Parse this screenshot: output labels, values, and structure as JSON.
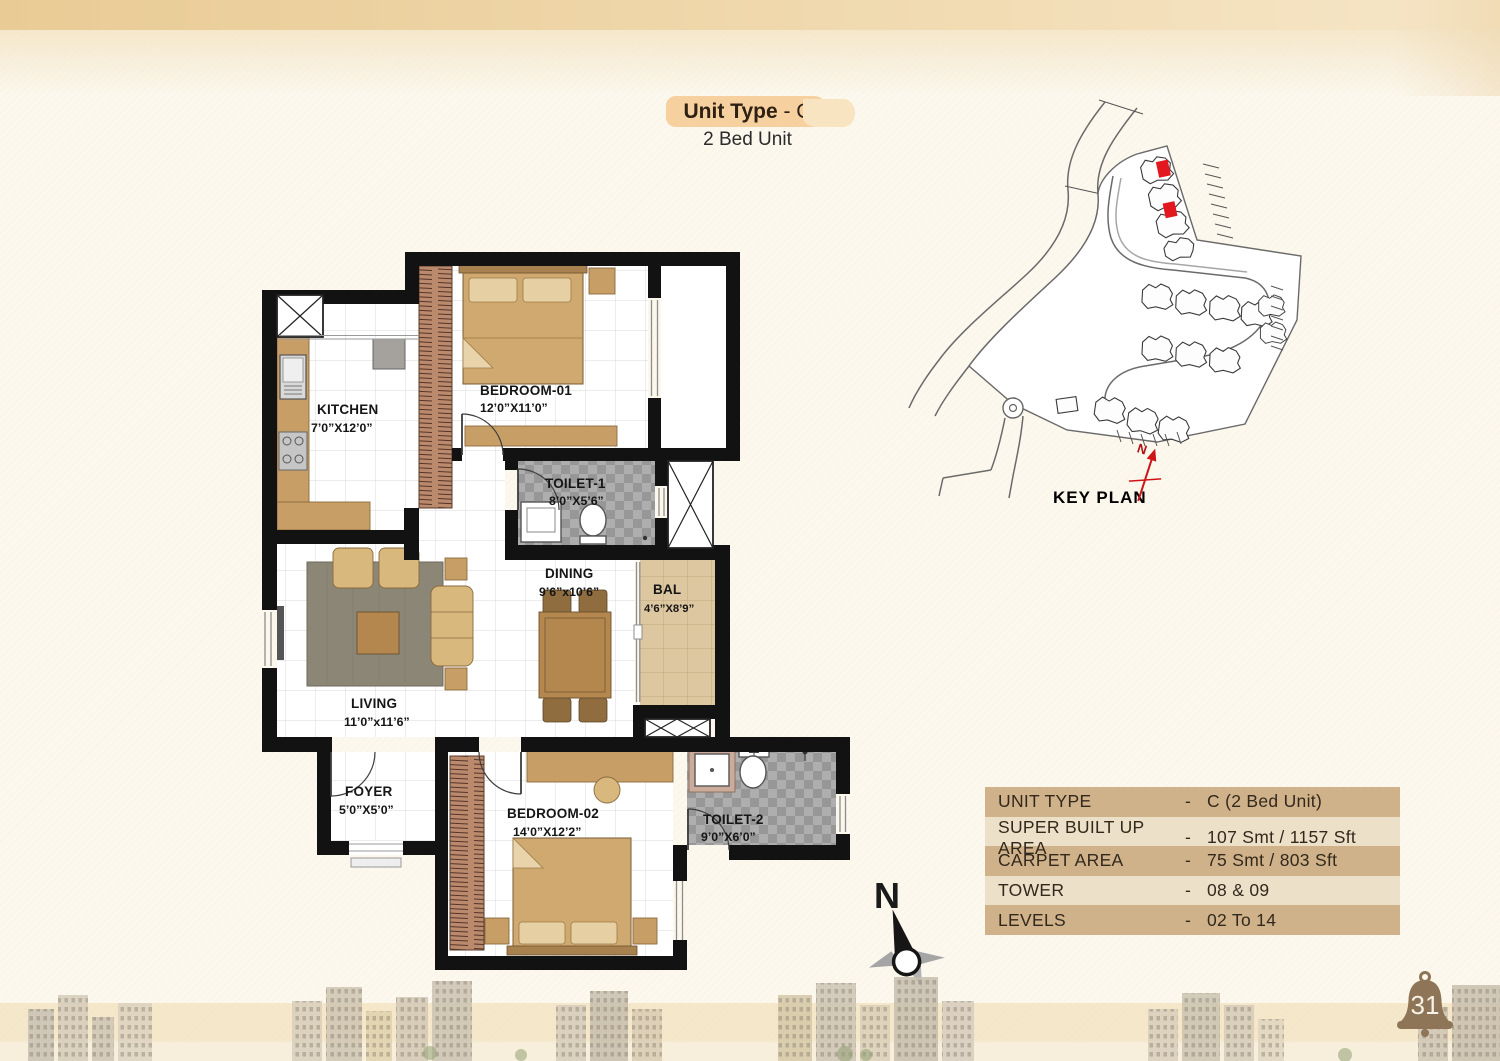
{
  "page": {
    "number": "31"
  },
  "colors": {
    "top_band": "#e9cb95",
    "title_badge": "#f6d09e",
    "table_row_dark": "#cfb28a",
    "table_row_light": "#ece1c8",
    "keyplan_highlight": "#e3181f",
    "bell": "#8e7557"
  },
  "title": {
    "label_bold": "Unit Type",
    "label_rest": " - C",
    "subtitle": "2 Bed Unit"
  },
  "key_plan": {
    "title": "KEY PLAN",
    "north_label": "N"
  },
  "north_compass": {
    "label": "N"
  },
  "floor_plan": {
    "rooms": [
      {
        "name": "BEDROOM-01",
        "dims": "12’0”X11’0”"
      },
      {
        "name": "KITCHEN",
        "dims": "7’0”X12’0”"
      },
      {
        "name": "TOILET-1",
        "dims": "8’0”X5’6”"
      },
      {
        "name": "DINING",
        "dims": "9’6”x10’6”"
      },
      {
        "name": "BAL",
        "dims": "4’6”X8’9”"
      },
      {
        "name": "LIVING",
        "dims": "11’0”x11’6”"
      },
      {
        "name": "FOYER",
        "dims": "5’0”X5’0”"
      },
      {
        "name": "BEDROOM-02",
        "dims": "14’0”X12’2”"
      },
      {
        "name": "TOILET-2",
        "dims": "9’0”X6’0”"
      }
    ]
  },
  "spec_table": {
    "rows": [
      {
        "label": "UNIT TYPE",
        "dash": "-",
        "value": "C (2 Bed Unit)"
      },
      {
        "label": "SUPER BUILT UP AREA",
        "dash": "-",
        "value": "107 Smt / 1157 Sft"
      },
      {
        "label": "CARPET AREA",
        "dash": "-",
        "value": "75 Smt / 803 Sft"
      },
      {
        "label": "TOWER",
        "dash": "-",
        "value": "08 & 09"
      },
      {
        "label": "LEVELS",
        "dash": "-",
        "value": "02 To 14"
      }
    ]
  }
}
